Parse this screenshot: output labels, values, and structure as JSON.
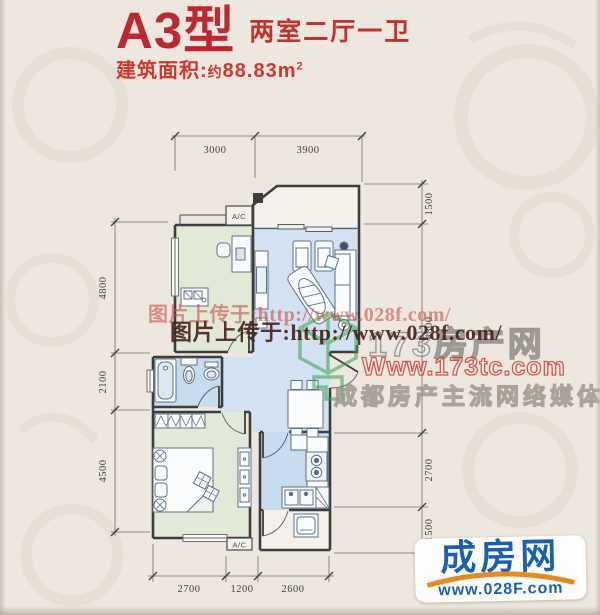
{
  "header": {
    "type_name": "A3型",
    "rooms_label": "两室二厅一卫",
    "area_label": "建筑面积:",
    "area_prefix": "约",
    "area_value": "88.83m",
    "area_sup": "2"
  },
  "plan": {
    "ac_top": "A/C",
    "ac_bottom": "A/C",
    "dims": {
      "top": [
        "3000",
        "3900"
      ],
      "left": [
        "4800",
        "2100",
        "4500"
      ],
      "right": [
        "1500",
        "4800",
        "2700",
        "1500"
      ],
      "bottom": [
        "2700",
        "1200",
        "2600"
      ]
    }
  },
  "watermarks": {
    "upload_light": "图片上传于:http://www.028f.com/",
    "upload_dark": "图片上传于:http://www.028f.com/",
    "site_name": "173房产网",
    "site_url": "Www.173tc.com",
    "slogan": "成都房产主流网络媒体"
  },
  "footer_logo": {
    "name": "成房网",
    "url": "www.028F.com"
  },
  "colors": {
    "accent_red": "#bf2730",
    "area_red": "#d0372e",
    "wall": "#3d3d3f",
    "room_green": "#e3e9d7",
    "room_blue": "#cfe1f1",
    "watermark_light_red": "#c9524a",
    "watermark_dark_red": "#461f1a",
    "logo_green": "#37a34a",
    "logo_gray": "#a9a29a",
    "url_red": "#c5342d",
    "chengfang_blue": "#1a5fb4",
    "chengfang_orange": "#e8891d"
  }
}
